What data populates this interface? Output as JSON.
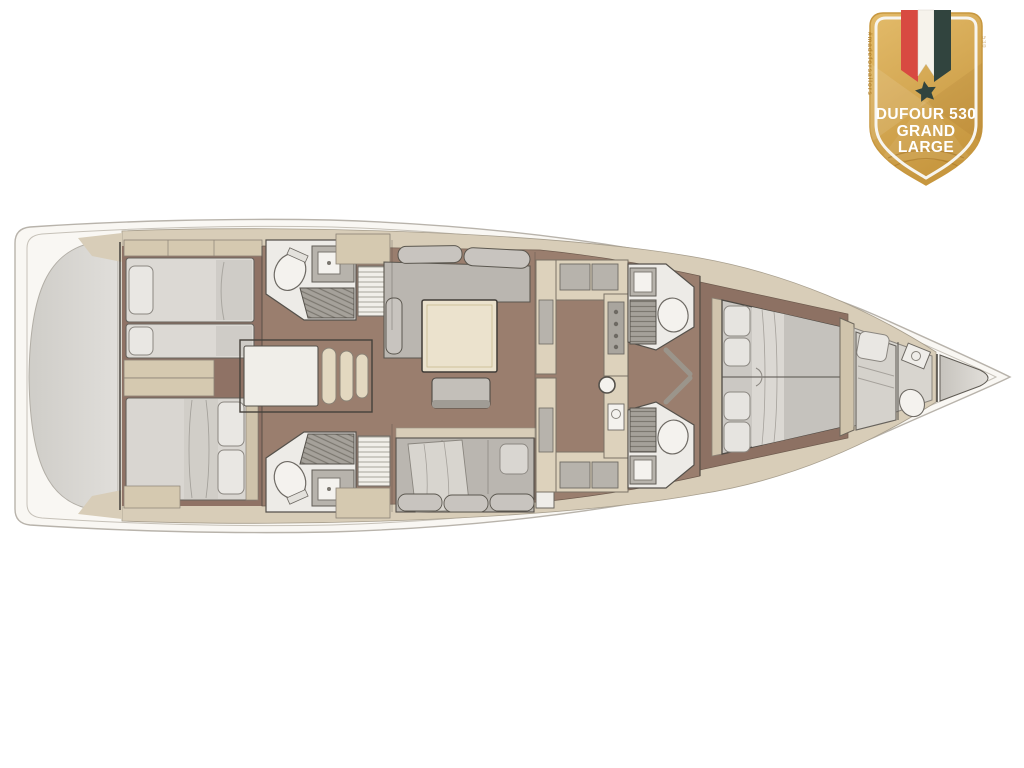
{
  "page": {
    "background": "#ffffff"
  },
  "badge": {
    "title_line1": "DUFOUR 530",
    "title_line2": "GRAND",
    "title_line3": "LARGE",
    "side_text_left": "#madeforsailors",
    "side_text_right": "530"
  },
  "colors": {
    "badge-gold": "#d9ae55",
    "badge-gold-light": "#e3bb6a",
    "badge-gold-deep": "#c7973f",
    "badge-border": "#f7f5ef",
    "ribbon-red": "#d84a41",
    "ribbon-white": "#f6f3ec",
    "ribbon-dark": "#31443e",
    "badge-text": "#ffffff",
    "badge-side-text": "#b07f2a",
    "hull-white": "#f9f7f3",
    "deck-beige": "#d8cdb8",
    "cabinet-beige": "#d5c9b0",
    "floor-wood": "#9a7e6e",
    "floor-wood-dark": "#8d7163",
    "upholstery-light": "#dcd9d4",
    "upholstery-gray": "#bab6b0",
    "table-cream": "#ebe2cd",
    "fixture-white": "#f4f2ee",
    "outline-dark": "#4e4a44",
    "transom-gray": "#dbd9d4"
  }
}
